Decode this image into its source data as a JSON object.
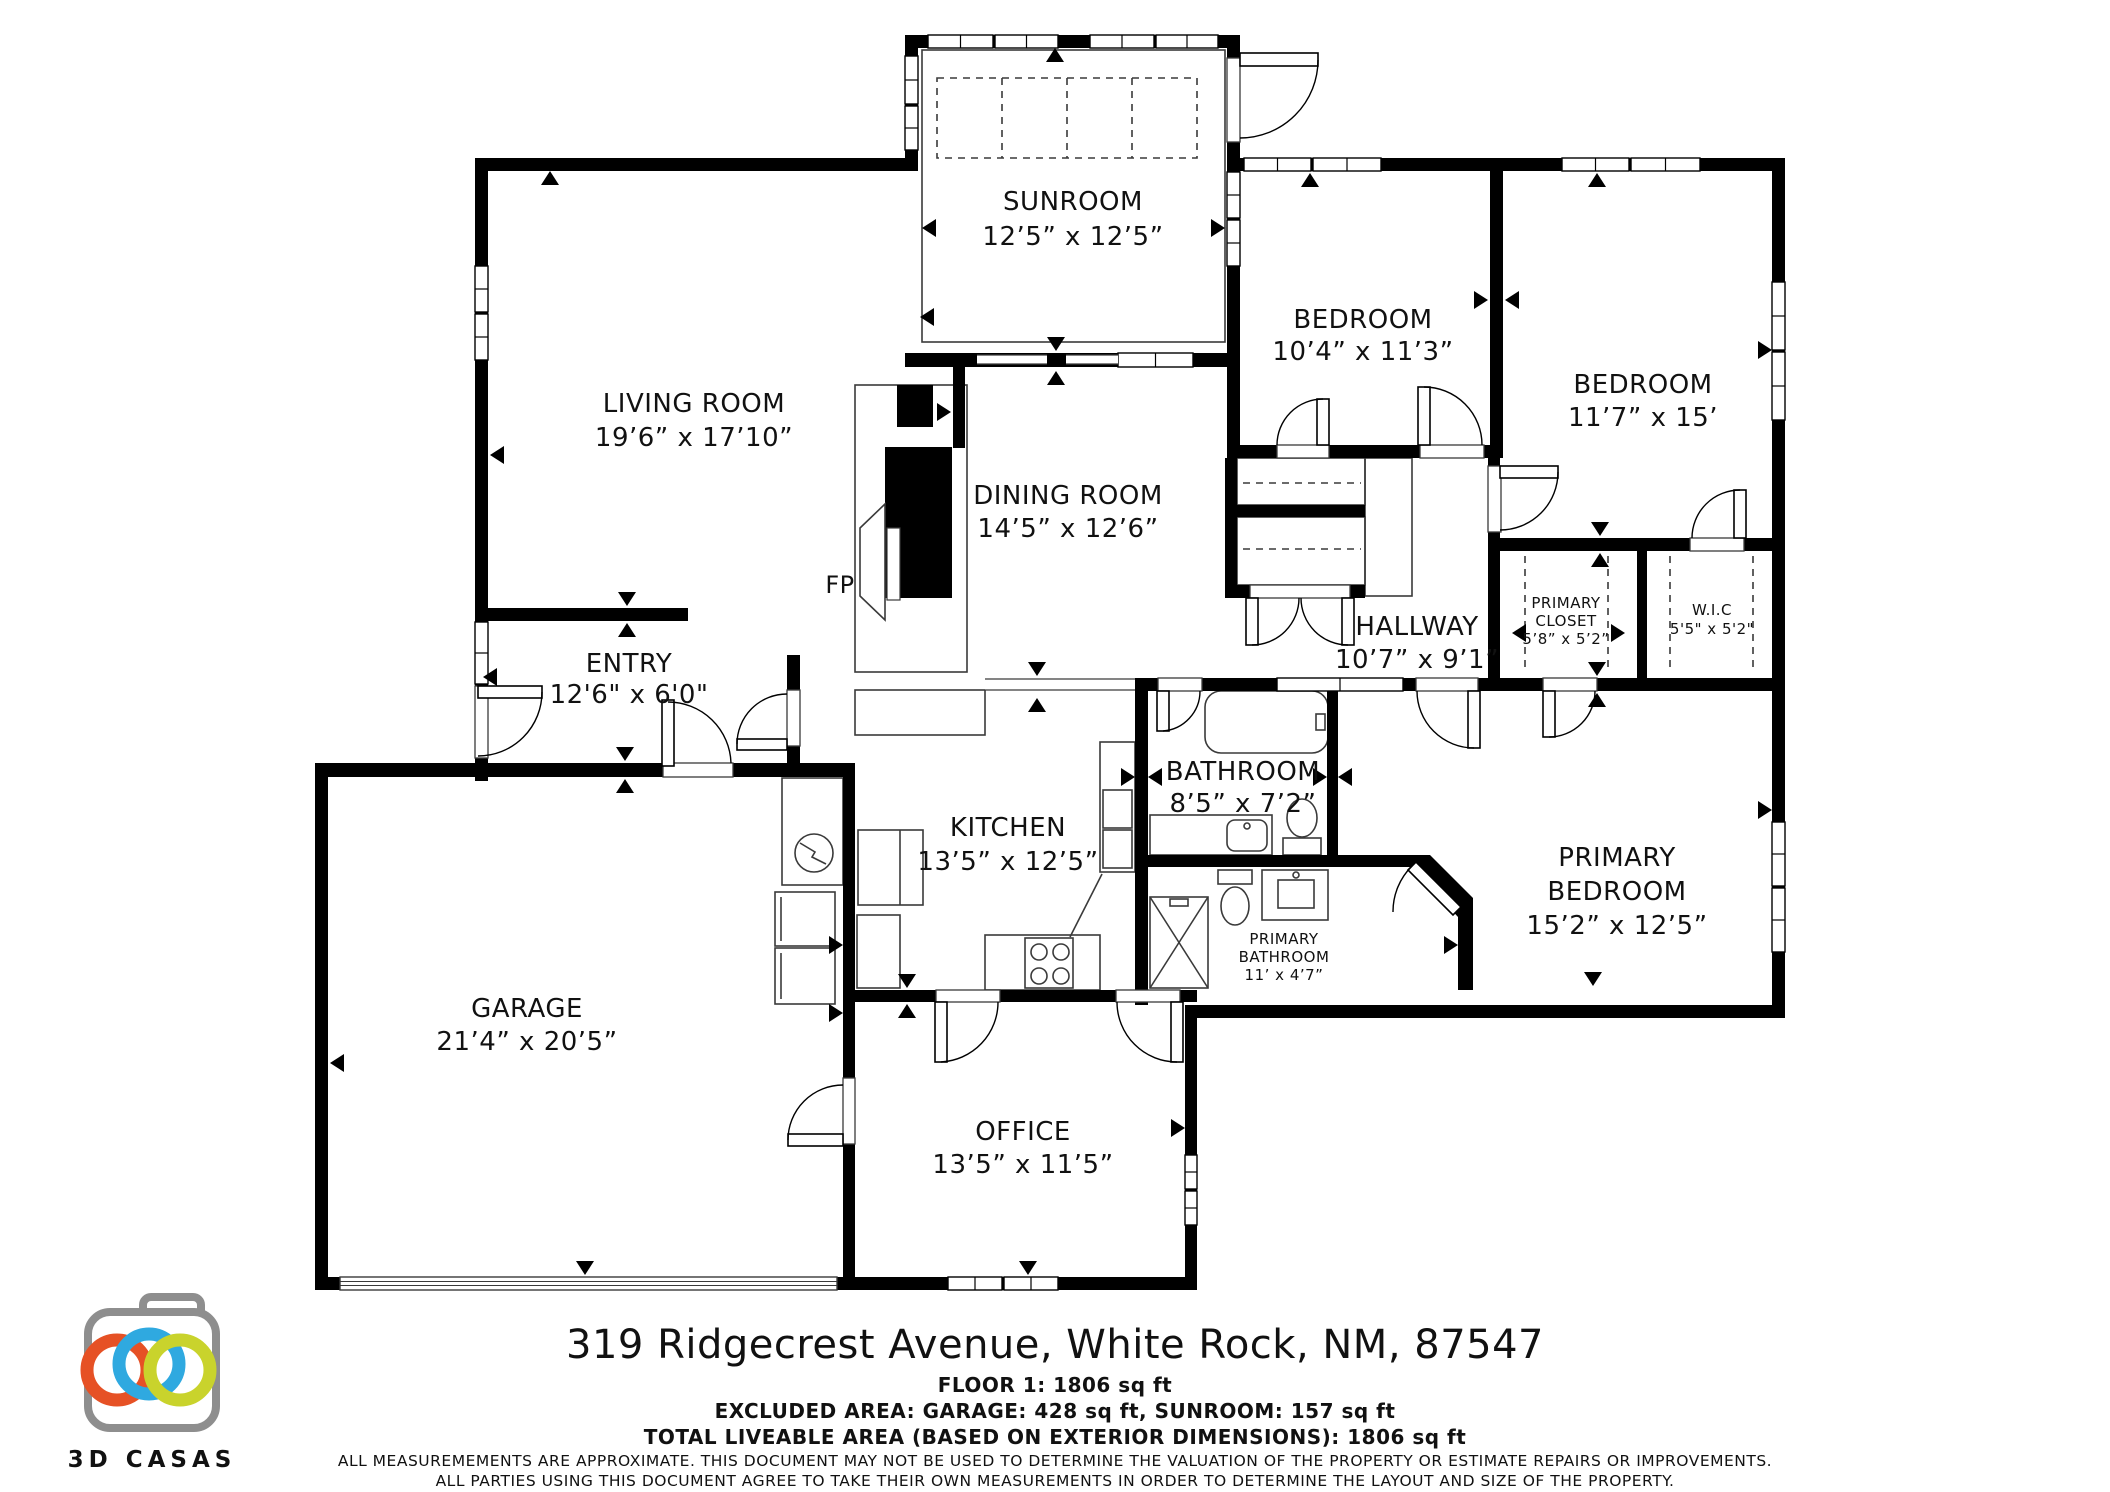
{
  "floorplan": {
    "rooms": {
      "sunroom": {
        "name": "SUNROOM",
        "dims": "12’5” x 12’5”"
      },
      "living_room": {
        "name": "LIVING ROOM",
        "dims": "19’6” x 17’10”"
      },
      "bedroom_top": {
        "name": "BEDROOM",
        "dims": "10’4” x 11’3”"
      },
      "bedroom_right": {
        "name": "BEDROOM",
        "dims": "11’7” x 15’"
      },
      "dining_room": {
        "name": "DINING ROOM",
        "dims": "14’5” x 12’6”"
      },
      "hallway": {
        "name": "HALLWAY",
        "dims": "10’7” x 9’1”"
      },
      "primary_closet": {
        "name_line1": "PRIMARY",
        "name_line2": "CLOSET",
        "dims": "5’8” x 5’2”"
      },
      "wic": {
        "name": "W.I.C",
        "dims": "5'5\" x 5'2\""
      },
      "entry": {
        "name": "ENTRY",
        "dims": "12'6\" x 6'0\""
      },
      "kitchen": {
        "name": "KITCHEN",
        "dims": "13’5” x 12’5”"
      },
      "bathroom": {
        "name": "BATHROOM",
        "dims": "8’5” x 7’2”"
      },
      "primary_bedroom": {
        "name_line1": "PRIMARY",
        "name_line2": "BEDROOM",
        "dims": "15’2” x 12’5”"
      },
      "primary_bathroom": {
        "name_line1": "PRIMARY",
        "name_line2": "BATHROOM",
        "dims": "11’ x 4’7”"
      },
      "garage": {
        "name": "GARAGE",
        "dims": "21’4” x 20’5”"
      },
      "office": {
        "name": "OFFICE",
        "dims": "13’5” x 11’5”"
      }
    },
    "fireplace_label": "FP"
  },
  "footer": {
    "address": "319 Ridgecrest Avenue, White Rock, NM, 87547",
    "floor_line": "FLOOR 1: 1806 sq ft",
    "excluded_line": "EXCLUDED AREA: GARAGE: 428 sq ft, SUNROOM: 157 sq ft",
    "total_line": "TOTAL LIVEABLE AREA (BASED ON EXTERIOR DIMENSIONS): 1806 sq ft",
    "disclaimer_line1": "ALL MEASUREMEMENTS ARE APPROXIMATE. THIS DOCUMENT MAY NOT BE USED TO DETERMINE THE VALUATION OF THE PROPERTY OR ESTIMATE REPAIRS OR IMPROVEMENTS.",
    "disclaimer_line2": "ALL PARTIES USING THIS DOCUMENT AGREE TO TAKE THEIR OWN MEASUREMENTS IN ORDER TO DETERMINE THE LAYOUT AND SIZE OF THE PROPERTY."
  },
  "logo": {
    "brand": "3D CASAS"
  },
  "colors": {
    "wall": "#000000",
    "logo_gray": "#8e8e8e",
    "logo_orange": "#e65125",
    "logo_blue": "#2fa9e0",
    "logo_green": "#c9d32c",
    "disclaimer_gray": "#9b9b9b"
  }
}
